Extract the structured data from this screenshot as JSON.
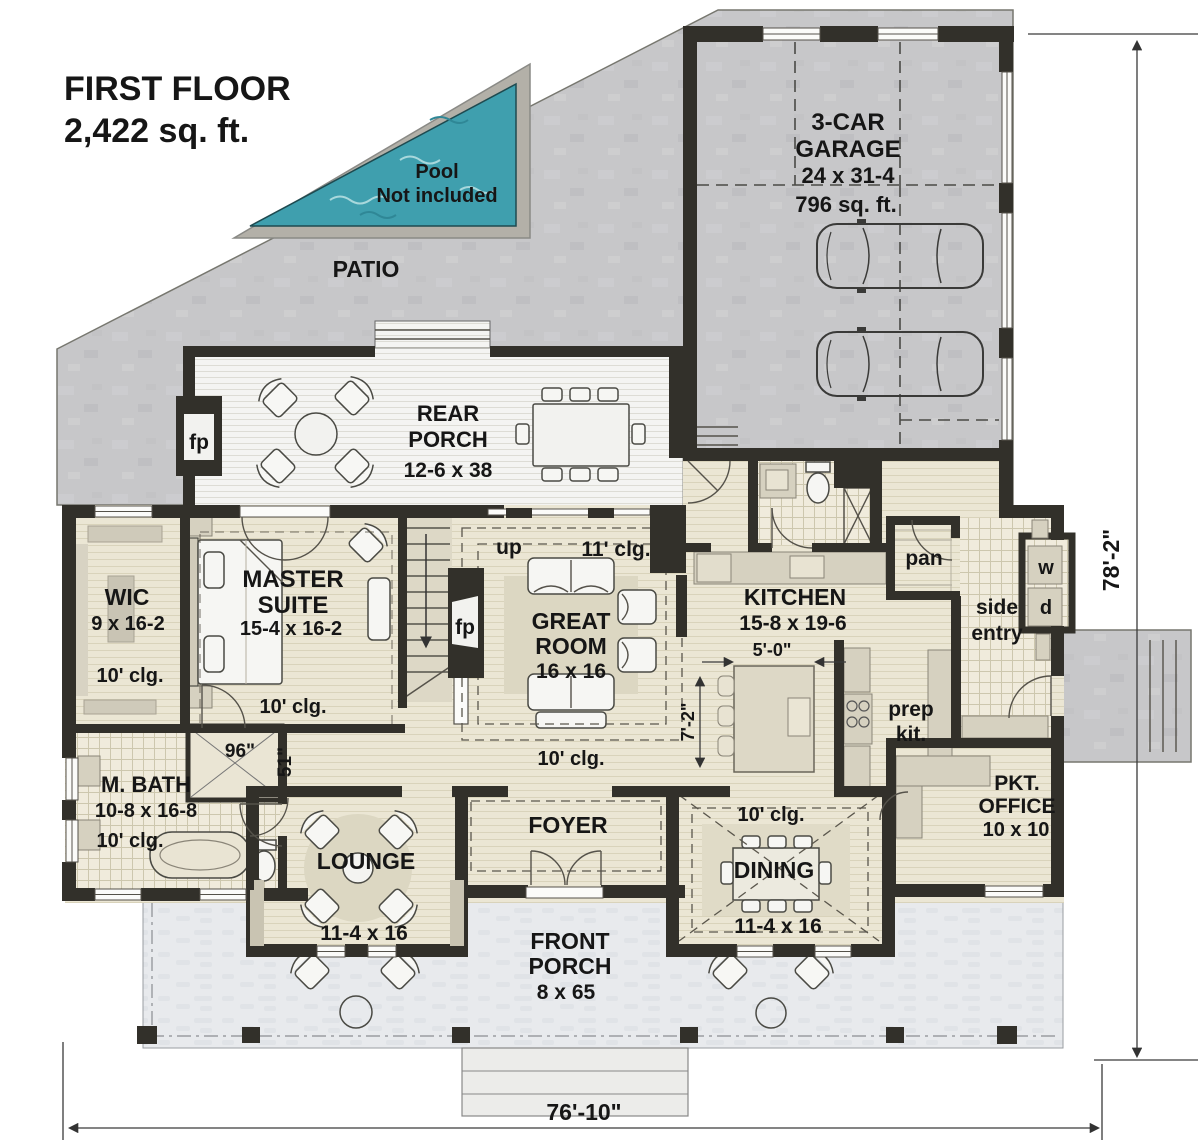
{
  "palette": {
    "wall": "#32302a",
    "concrete": "#c7c7c9",
    "pool_water": "#3f9fae",
    "floor": "#ebe6d4",
    "porch": "#f4f4f2",
    "front_porch": "#e8eaed",
    "tile": "#f0ebdc"
  },
  "title": {
    "line1": "FIRST FLOOR",
    "line2": "2,422 sq. ft."
  },
  "site": {
    "patio": "PATIO",
    "pool_line1": "Pool",
    "pool_line2": "Not included"
  },
  "garage": {
    "line1": "3-CAR",
    "line2": "GARAGE",
    "dims": "24 x 31-4",
    "area": "796 sq. ft."
  },
  "rear_porch": {
    "line1": "REAR",
    "line2": "PORCH",
    "dims": "12-6 x 38",
    "fireplace": "fp"
  },
  "wic": {
    "name": "WIC",
    "dims": "9 x 16-2",
    "ceiling": "10' clg."
  },
  "master": {
    "line1": "MASTER",
    "line2": "SUITE",
    "dims": "15-4 x 16-2",
    "ceiling": "10' clg."
  },
  "great_room": {
    "line1": "GREAT",
    "line2": "ROOM",
    "dims": "16 x 16",
    "ceiling": "11' clg.",
    "hall_ceiling": "10' clg.",
    "stairs": "up",
    "fireplace": "fp"
  },
  "kitchen": {
    "name": "KITCHEN",
    "dims": "15-8 x 19-6",
    "island_width": "5'-0\"",
    "island_clearance": "7'-2\"",
    "pantry": "pan"
  },
  "prep_kitchen": {
    "line1": "prep",
    "line2": "kit."
  },
  "side_entry": {
    "line1": "side",
    "line2": "entry",
    "washer": "w",
    "dryer": "d"
  },
  "office": {
    "line1": "PKT.",
    "line2": "OFFICE",
    "dims": "10 x 10"
  },
  "master_bath": {
    "name": "M. BATH",
    "dims": "10-8 x 16-8",
    "ceiling": "10' clg.",
    "shower_width": "96\"",
    "shower_depth": "51\""
  },
  "lounge": {
    "name": "LOUNGE",
    "dims": "11-4 x 16"
  },
  "foyer": {
    "name": "FOYER"
  },
  "dining": {
    "name": "DINING",
    "dims": "11-4 x 16",
    "ceiling": "10' clg."
  },
  "front_porch": {
    "line1": "FRONT",
    "line2": "PORCH",
    "dims": "8 x 65"
  },
  "dimensions": {
    "overall_width": "76'-10\"",
    "overall_depth": "78'-2\""
  }
}
